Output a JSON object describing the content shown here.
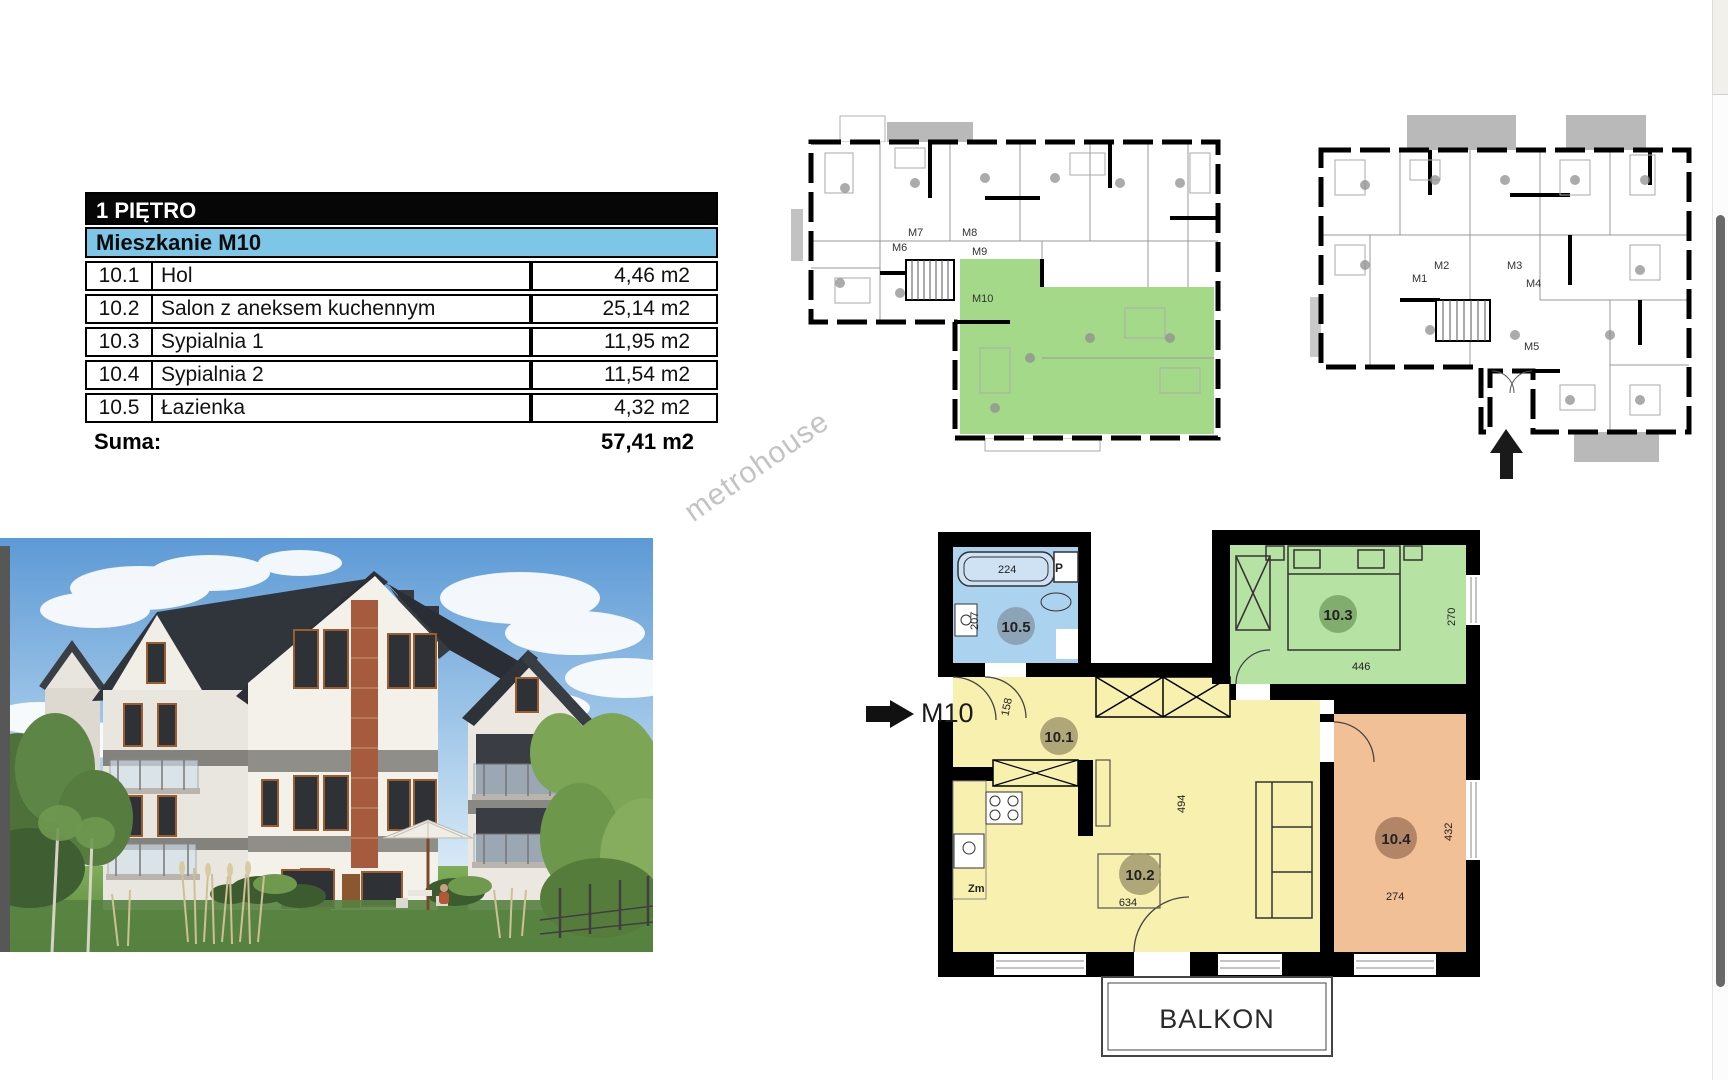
{
  "table": {
    "floor_header": "1 PIĘTRO",
    "unit_header": "Mieszkanie M10",
    "rows": [
      {
        "code": "10.1",
        "name": "Hol",
        "area": "4,46 m2"
      },
      {
        "code": "10.2",
        "name": "Salon z aneksem kuchennym",
        "area": "25,14 m2"
      },
      {
        "code": "10.3",
        "name": "Sypialnia 1",
        "area": "11,95 m2"
      },
      {
        "code": "10.4",
        "name": "Sypialnia 2",
        "area": "11,54 m2"
      },
      {
        "code": "10.5",
        "name": "Łazienka",
        "area": "4,32 m2"
      }
    ],
    "total_label": "Suma:",
    "total_value": "57,41 m2"
  },
  "watermark": "metrohouse",
  "plans_overview": {
    "first_floor": {
      "apartments": [
        "M6",
        "M7",
        "M8",
        "M9",
        "M10"
      ],
      "highlighted_apartment": "M10"
    },
    "ground_floor": {
      "apartments": [
        "M1",
        "M2",
        "M3",
        "M4",
        "M5"
      ]
    }
  },
  "m10_plan": {
    "entrance_label": "M10",
    "balcony_label": "BALKON",
    "rooms": [
      {
        "id": "10.5",
        "type": "bathroom",
        "width_cm": "224",
        "height_cm": "207",
        "washer_label": "P",
        "color": "#abd3ef"
      },
      {
        "id": "10.1",
        "type": "hall",
        "dim_cm": "158"
      },
      {
        "id": "10.2",
        "type": "living-kitchen",
        "width_cm": "634",
        "height_cm": "494",
        "sink_label": "Zm",
        "color": "#f8f0ae"
      },
      {
        "id": "10.3",
        "type": "bedroom-1",
        "width_cm": "446",
        "height_cm": "270",
        "color": "#b6e2a4"
      },
      {
        "id": "10.4",
        "type": "bedroom-2",
        "width_cm": "274",
        "height_cm": "432",
        "color": "#f2c097"
      }
    ]
  },
  "colors": {
    "table_header_bg": "#060606",
    "table_unit_bg": "#7dc6e8",
    "plan_highlight_green": "#a5d98a",
    "bathroom_blue": "#abd3ef",
    "living_yellow": "#f8f0ae",
    "bedroom1_green": "#b6e2a4",
    "bedroom2_orange": "#f2c097"
  }
}
